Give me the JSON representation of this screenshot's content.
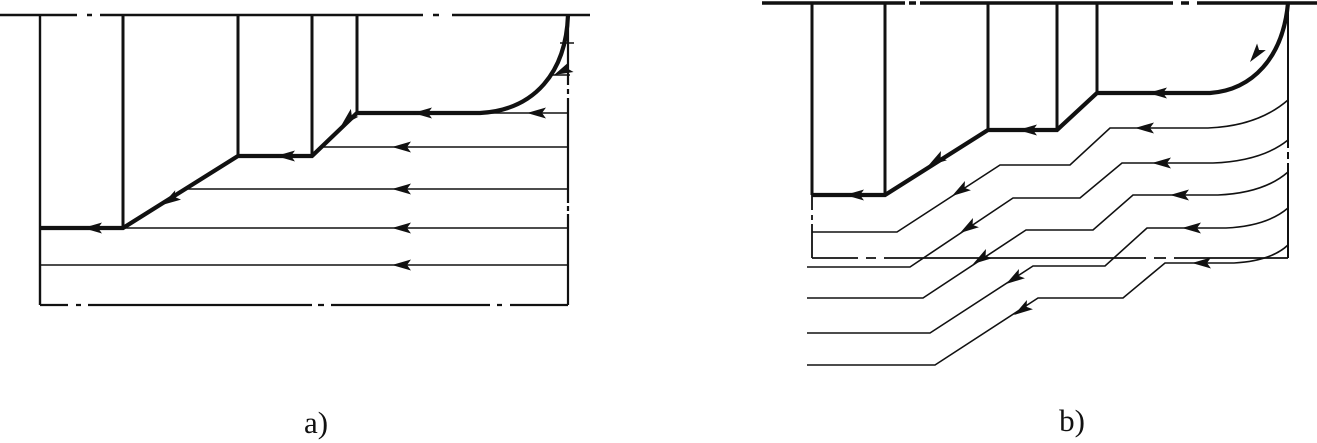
{
  "canvas": {
    "width": 1317,
    "height": 443,
    "background": "#ffffff",
    "ink": "#111111"
  },
  "labels": {
    "a": "a)",
    "b": "b)"
  },
  "arrow_glyph": "M0,0 L19,-5.5 L15,0 L19,5.5 Z",
  "diagrams": [
    {
      "id": "a",
      "name": "straight-longitudinal-passes-scheme",
      "paths": [
        {
          "name": "blank-top-line",
          "w": 2.4,
          "d": "M0,15 H77 M87,15 h5 M100,15 H423 M433,15 h6 M452,15 H590"
        },
        {
          "name": "blank-left-edge",
          "w": 2.4,
          "d": "M40,15 V305"
        },
        {
          "name": "blank-bottom-line",
          "w": 2.2,
          "d": "M40,305 H68 M76,305 h5 M88,305 H312 M318,305 h6 M331,305 H490 M497,305 h5 M510,305 H568"
        },
        {
          "name": "blank-right-edge",
          "w": 2.2,
          "d": "M568,15 V85 M568,89 v5 M568,98 V203 M568,206 v5 M568,214 V305"
        },
        {
          "name": "step-projection-lines",
          "w": 3.0,
          "d": "M123,15 V228 M238,15 V156 M312,15 V156 M357,15 V113"
        },
        {
          "name": "part-profile",
          "w": 4.2,
          "d": "M40,228 H123 L238,156 H312 L357,113 H480 C535,110 566,72 568,15"
        },
        {
          "name": "tool-pass-lines",
          "w": 1.6,
          "d": "M480,113 H568 M322,147 H568 M185,189 H568 M123,228 H568 M40,265 H568 M560,43 H574 M552,75 H570"
        }
      ],
      "arrows": [
        [
          83,
          228,
          180
        ],
        [
          162,
          205,
          148
        ],
        [
          276,
          156,
          180
        ],
        [
          341,
          126,
          136
        ],
        [
          413,
          113,
          180
        ],
        [
          527,
          113,
          180
        ],
        [
          392,
          147,
          180
        ],
        [
          392,
          189,
          180
        ],
        [
          392,
          228,
          180
        ],
        [
          392,
          265,
          180
        ],
        [
          554,
          75,
          155
        ]
      ]
    },
    {
      "id": "b",
      "name": "contour-copying-passes-scheme",
      "paths": [
        {
          "name": "blank-top-line",
          "w": 3.6,
          "d": "M762,3 H905 M909,3 h7 M920,3 H1173 M1181,3 h8 M1197,3 H1317"
        },
        {
          "name": "blank-right-edge",
          "w": 2.0,
          "d": "M1288,3 V148 M1288,152 v7 M1288,163 V258"
        },
        {
          "name": "axis-line",
          "w": 1.8,
          "d": "M812,258 H858 M866,258 h10 M884,258 H1146 M1154,258 h12 M1174,258 H1288"
        },
        {
          "name": "part-left-edge",
          "w": 3.0,
          "d": "M812,3 V195"
        },
        {
          "name": "part-left-edge-extension",
          "w": 1.8,
          "d": "M812,195 V210 M812,215 v5 M812,224 V258"
        },
        {
          "name": "step-projection-lines",
          "w": 3.0,
          "d": "M885,3 V195 M988,3 V130 M1057,3 V130 M1097,3 V93"
        },
        {
          "name": "part-profile",
          "w": 4.2,
          "d": "M812,195 H885 L988,130 H1057 L1097,93 H1210 C1252,90 1283,58 1288,3"
        },
        {
          "name": "tool-pass-1",
          "w": 1.6,
          "d": "M812,232 H897 L1000,165 H1070 L1110,128 H1208 Q1258,126 1288,100"
        },
        {
          "name": "tool-pass-2",
          "w": 1.6,
          "d": "M807,267 H910 L1013,198 H1080 L1122,163 H1213 Q1262,161 1288,140"
        },
        {
          "name": "tool-pass-3",
          "w": 1.6,
          "d": "M807,298 H923 L1026,230 H1093 L1133,195 H1218 Q1264,193 1288,172"
        },
        {
          "name": "tool-pass-4",
          "w": 1.6,
          "d": "M807,333 H930 L1033,266 H1105 L1147,228 H1226 Q1267,226 1288,208"
        },
        {
          "name": "tool-pass-5",
          "w": 1.6,
          "d": "M807,365 H935 L1038,298 H1123 L1165,263 H1234 Q1271,261 1288,245"
        }
      ],
      "arrows": [
        [
          845,
          195,
          180
        ],
        [
          928,
          166,
          147
        ],
        [
          1018,
          130,
          180
        ],
        [
          1148,
          93,
          180
        ],
        [
          1250,
          62,
          127
        ],
        [
          952,
          196,
          147
        ],
        [
          960,
          233,
          147
        ],
        [
          973,
          264,
          147
        ],
        [
          1006,
          284,
          147
        ],
        [
          1014,
          315,
          147
        ],
        [
          1135,
          128,
          180
        ],
        [
          1152,
          163,
          180
        ],
        [
          1170,
          195,
          180
        ],
        [
          1182,
          228,
          180
        ],
        [
          1192,
          263,
          180
        ]
      ]
    }
  ]
}
